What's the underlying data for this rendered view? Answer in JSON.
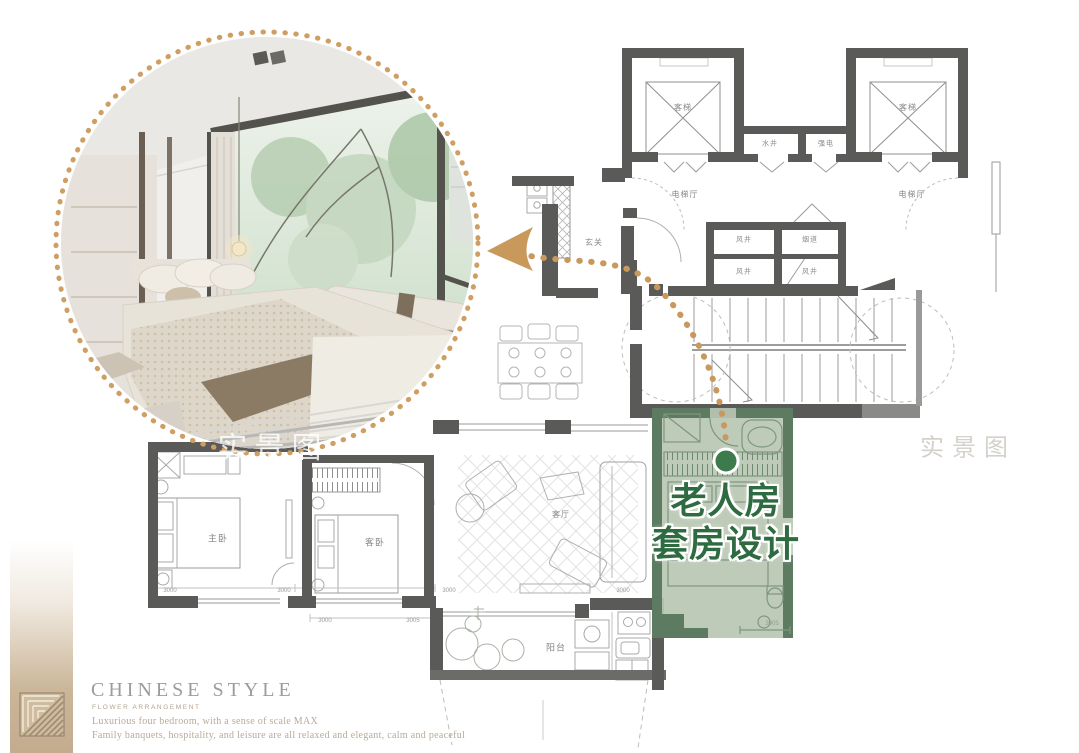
{
  "branding": {
    "title": "CHINESE STYLE",
    "subtitle": "FLOWER ARRANGEMENT",
    "desc1": "Luxurious four bedroom, with a sense of scale MAX",
    "desc2": "Family banquets, hospitality, and leisure are all relaxed and elegant, calm and peaceful"
  },
  "callout": {
    "line1": "老人房",
    "line2": "套房设计"
  },
  "watermarks": {
    "photo": "实景图",
    "plan": "实景图"
  },
  "floorplan": {
    "labels": {
      "elevator_left": "客梯",
      "elevator_right": "客梯",
      "water_shaft": "水井",
      "strong_electric": "强电",
      "hall_left": "电梯厅",
      "hall_right": "电梯厅",
      "wind_shaft_a": "风井",
      "flue": "烟道",
      "wind_shaft_b": "风井",
      "wind_shaft_c": "风井",
      "entry": "玄关",
      "living": "客厅",
      "master_bedroom": "主卧",
      "guest_bedroom": "客卧",
      "balcony": "阳台"
    },
    "dimensions": [
      "3000",
      "3000",
      "3000",
      "3005",
      "3000",
      "3000",
      "3005"
    ]
  },
  "colors": {
    "accent_tan": "#c9995c",
    "ring_tan": "#cf9e63",
    "green_fill": "#b8c7b2",
    "green_wall": "#5d7b60",
    "green_text": "#2e6b40",
    "green_dot": "#3d7a4c",
    "wall_gray": "#5a5a58"
  }
}
